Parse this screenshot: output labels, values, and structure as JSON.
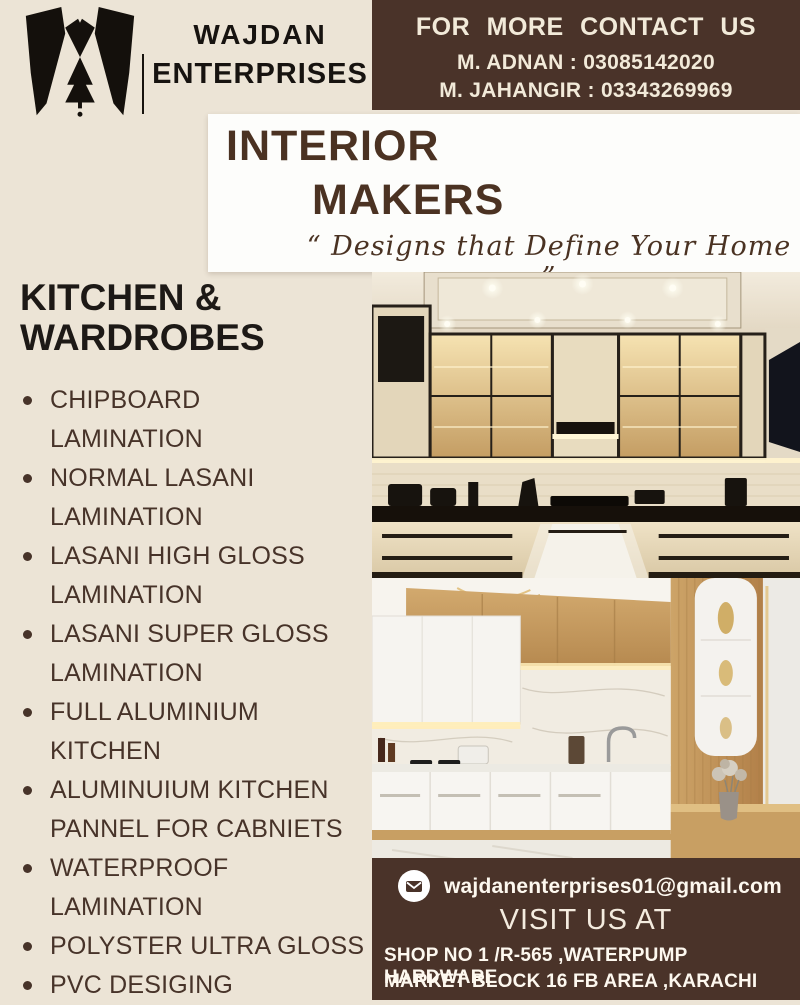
{
  "colors": {
    "background": "#ece4d6",
    "brown": "#4a3329",
    "title_brown": "#4b3222",
    "heading_black": "#1d1916",
    "list_text": "#473329",
    "cream_text": "#f2ead9"
  },
  "header": {
    "logo_icon": "wajdan-w-monogram-icon",
    "brand_line1": "WAJDAN",
    "brand_line2": "ENTERPRISES",
    "contact": {
      "title": "FOR MORE CONTACT US",
      "lines": [
        "M. ADNAN : 03085142020",
        "M. JAHANGIR : 03343269969"
      ]
    }
  },
  "title_banner": {
    "line1": "INTERIOR",
    "line2": "MAKERS",
    "tagline": "“ Designs that Define Your Home ”"
  },
  "services": {
    "heading": "KITCHEN &\nWARDROBES",
    "items": [
      "CHIPBOARD\nLAMINATION",
      "NORMAL LASANI\nLAMINATION",
      "LASANI HIGH GLOSS\nLAMINATION",
      "LASANI SUPER GLOSS\nLAMINATION",
      "FULL ALUMINIUM\nKITCHEN",
      "ALUMINUIUM KITCHEN\nPANNEL FOR CABNIETS",
      "WATERPROOF\nLAMINATION",
      "POLYSTER ULTRA GLOSS",
      "PVC DESIGING"
    ]
  },
  "gallery": {
    "photo1": "cream-black-glass-kitchen-photo",
    "photo2": "white-wood-kitchen-photo"
  },
  "footer": {
    "email_icon": "envelope-icon",
    "email": "wajdanenterprises01@gmail.com",
    "visit_label": "VISIT US AT",
    "address_line1": "SHOP NO 1 /R-565 ,WATERPUMP HARDWARE",
    "address_line2": "MARKET BLOCK 16 FB AREA ,KARACHI"
  }
}
